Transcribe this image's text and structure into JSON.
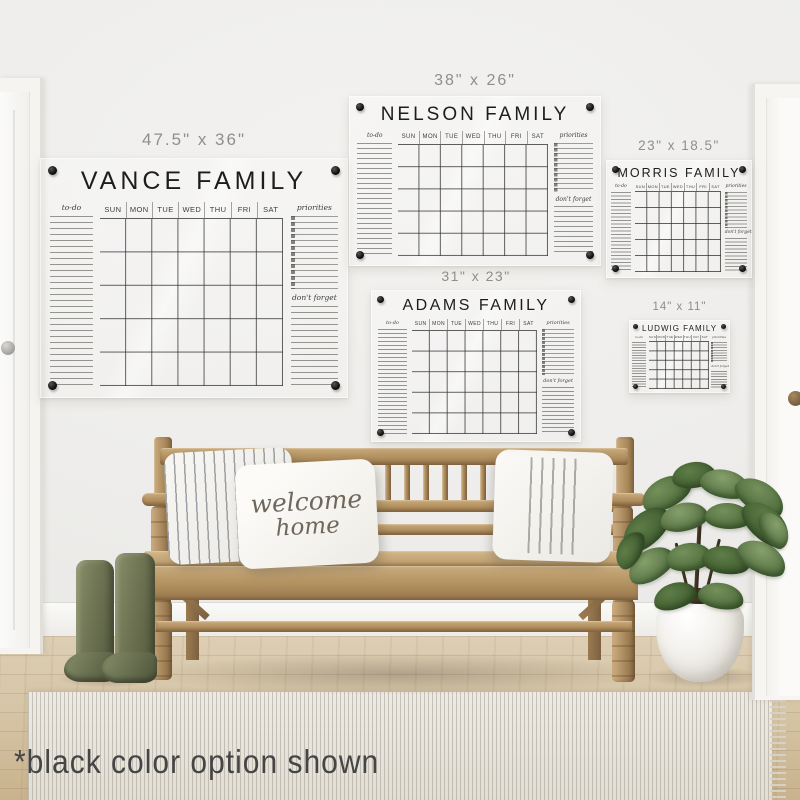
{
  "footnote": "*black color option shown",
  "pillow": {
    "line1": "welcome",
    "line2": "home"
  },
  "calendar_common": {
    "todo_label": "to-do",
    "priorities_label": "priorities",
    "dont_forget_label": "don't forget",
    "weekdays": [
      "SUN",
      "MON",
      "TUE",
      "WED",
      "THU",
      "FRI",
      "SAT"
    ]
  },
  "calendars": [
    {
      "name": "VANCE FAMILY",
      "size": "47.5\" x 36\""
    },
    {
      "name": "NELSON FAMILY",
      "size": "38\" x 26\""
    },
    {
      "name": "MORRIS FAMILY",
      "size": "23\" x 18.5\""
    },
    {
      "name": "ADAMS FAMILY",
      "size": "31\" x 23\""
    },
    {
      "name": "LUDWIG FAMILY",
      "size": "14\" x 11\""
    }
  ],
  "colors": {
    "calendar_ink": "#1d1d1b",
    "mount_dot": "#0b0b0b",
    "wall": "#efeeec",
    "wood": "#b2905f",
    "boot_green": "#6a7050",
    "leaf_green": "#4c6a3a",
    "rug": "#e9e6df",
    "floor": "#d6c5a6"
  }
}
